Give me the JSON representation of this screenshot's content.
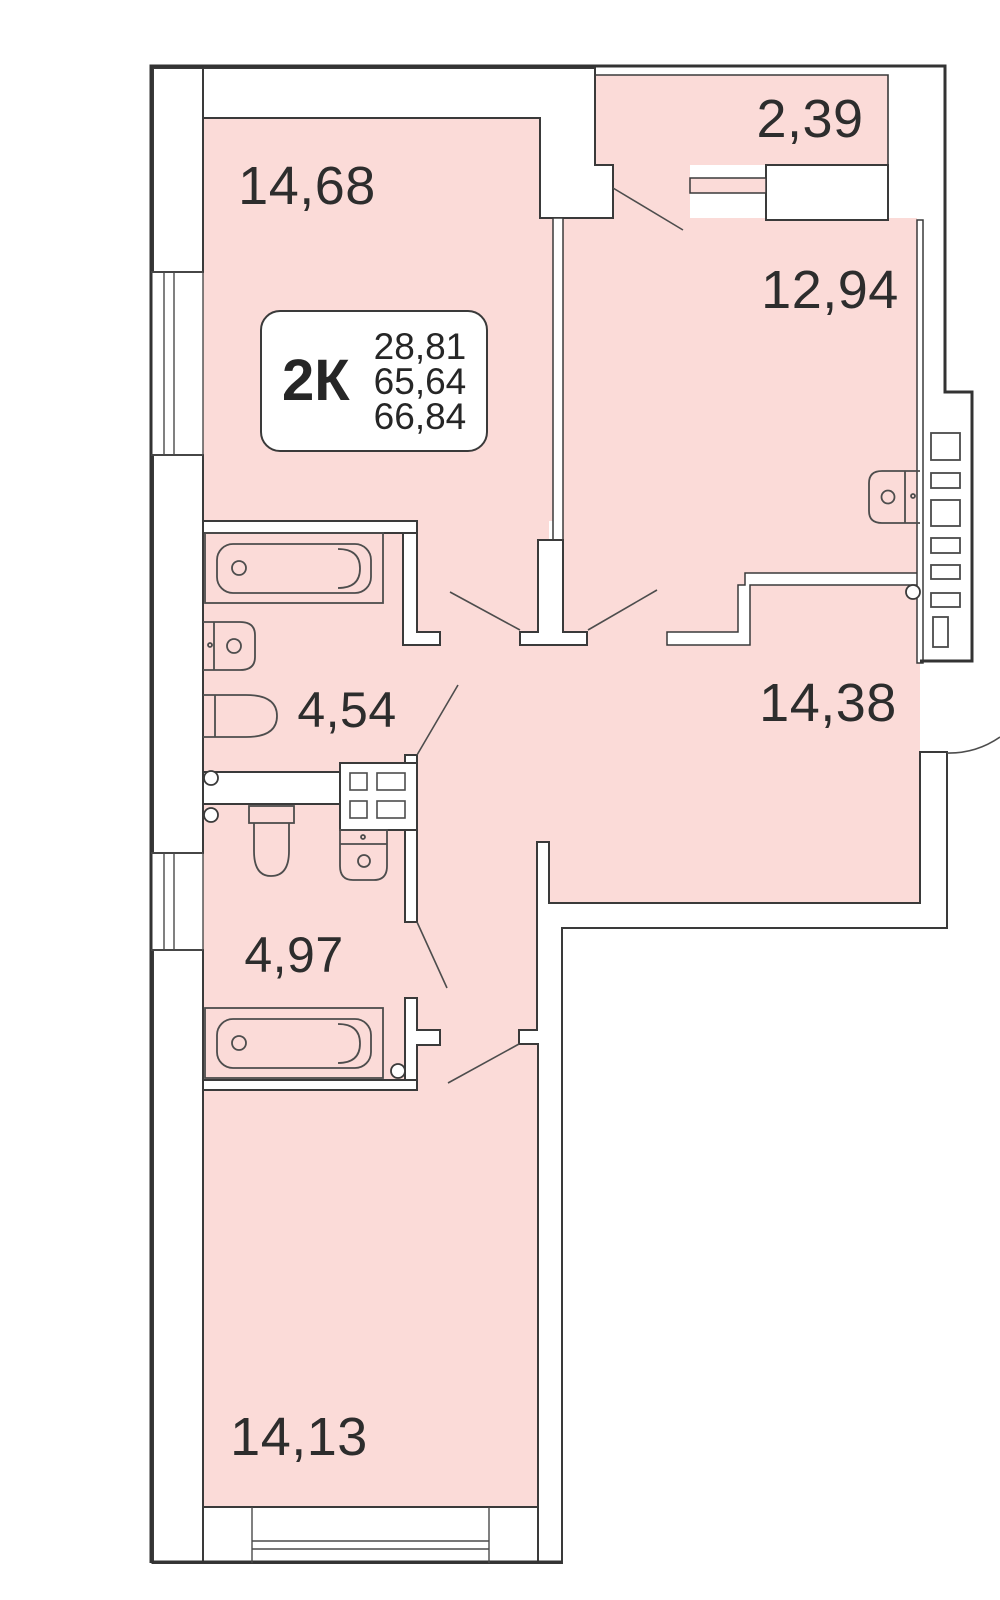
{
  "plan": {
    "unit": {
      "type_label": "2К",
      "living_area": "28,81",
      "area_without_balcony": "65,64",
      "total_area": "66,84"
    },
    "rooms": [
      {
        "name": "bedroom",
        "area": "14,68"
      },
      {
        "name": "balcony",
        "area": "2,39"
      },
      {
        "name": "kitchen",
        "area": "12,94"
      },
      {
        "name": "bathroom",
        "area": "4,54"
      },
      {
        "name": "hall",
        "area": "14,38"
      },
      {
        "name": "wc",
        "area": "4,97"
      },
      {
        "name": "living-room",
        "area": "14,13"
      }
    ],
    "colors": {
      "room_fill": "#fbdbd8",
      "wall_stroke": "#3a3a3a",
      "label_text": "#2d2d2d"
    }
  }
}
